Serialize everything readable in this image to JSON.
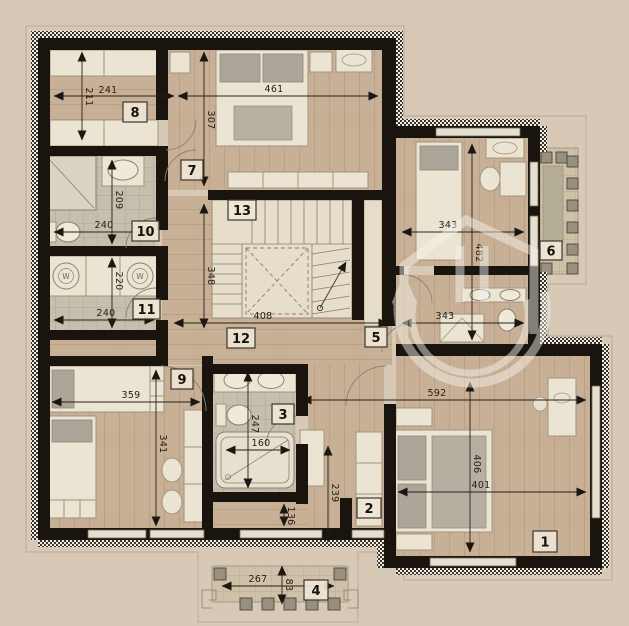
{
  "palette": {
    "background": "#d8c9b6",
    "wall": "#19140e",
    "wood_floor": "#c8b096",
    "tile_floor": "#c6bfae",
    "furniture": "#ece4d3",
    "soft_gray": "#aca59a",
    "balcony_floor": "#cfc1a8",
    "dimension_text": "#262019",
    "watermark": "#f6f3ec"
  },
  "rooms": [
    {
      "number": "1"
    },
    {
      "number": "2"
    },
    {
      "number": "3"
    },
    {
      "number": "4"
    },
    {
      "number": "5"
    },
    {
      "number": "6"
    },
    {
      "number": "7"
    },
    {
      "number": "8"
    },
    {
      "number": "9"
    },
    {
      "number": "10"
    },
    {
      "number": "11"
    },
    {
      "number": "12"
    },
    {
      "number": "13"
    }
  ],
  "dims": {
    "v211": "211",
    "h241": "241",
    "h461": "461",
    "v307": "307",
    "v209": "209",
    "h240a": "240",
    "v220": "220",
    "h240b": "240",
    "v348": "348",
    "h408": "408",
    "h343a": "343",
    "v482": "482",
    "h343b": "343",
    "h359": "359",
    "v341": "341",
    "v247": "247",
    "h160": "160",
    "v136": "136",
    "v239": "239",
    "h592": "592",
    "v406": "406",
    "h401": "401",
    "h267": "267",
    "v83": "83"
  },
  "labels": {
    "washer": "W"
  }
}
